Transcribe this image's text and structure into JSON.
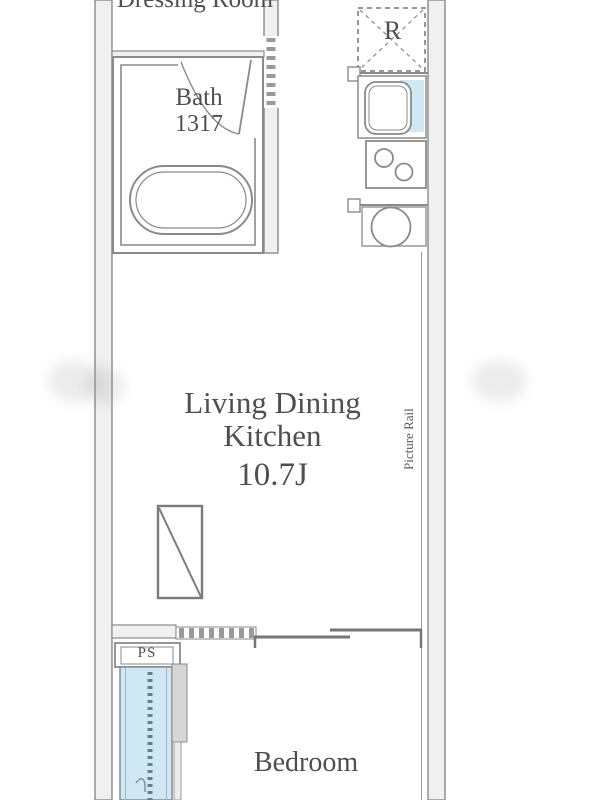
{
  "plan": {
    "type": "apartment-floor-plan",
    "rooms": {
      "dressing_room": {
        "label": "Dressing Room"
      },
      "bath": {
        "label": "Bath",
        "size": "1317"
      },
      "living_dining_kitchen": {
        "label": "Living Dining Kitchen",
        "size": "10.7J"
      },
      "bedroom": {
        "label": "Bedroom"
      }
    },
    "labels": {
      "refrigerator": "R",
      "pipe_space": "PS",
      "picture_rail": "Picture Rail"
    },
    "fixtures": [
      "bathtub",
      "bath-door-swing",
      "refrigerator-space",
      "kitchen-sink",
      "drainboard",
      "two-burner-stove",
      "round-kitchen-fixture",
      "storage-rect",
      "sliding-partition",
      "pipe-space-box",
      "window-strip"
    ],
    "colors": {
      "wall_line": "#8a8a8a",
      "wall_fill": "#f0f0f0",
      "text": "#4f4f4f",
      "water_blue": "#cfe8f4",
      "background": "#ffffff"
    }
  }
}
